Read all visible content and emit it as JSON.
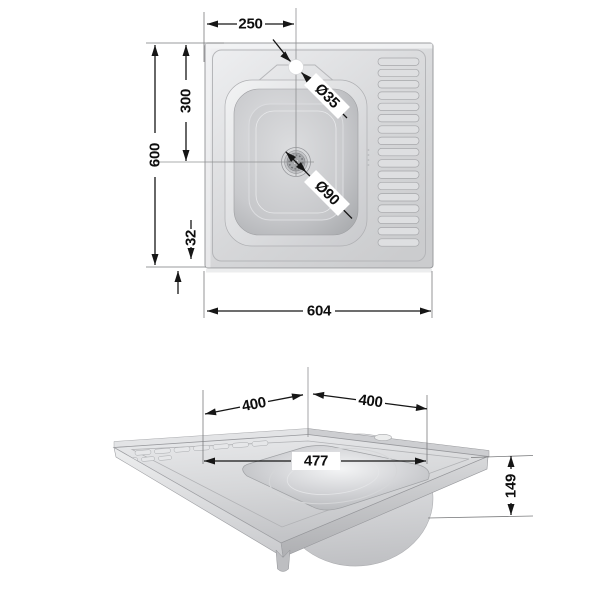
{
  "drawing": {
    "colors": {
      "dimension_line": "#161616",
      "extension_line": "#7a7b7d",
      "steel_light": "#eff0f2",
      "steel_mid": "#d3d4d7",
      "steel_dark": "#a8aaad",
      "label_chip": "#ffffff",
      "background": "#ffffff"
    },
    "top_view": {
      "dims": {
        "bowl_center_from_left": "250",
        "overall_depth": "600",
        "bowl_center_from_top": "300",
        "bottom_edge_offset": "32",
        "overall_width": "604",
        "faucet_hole_diameter": "Ø35",
        "drain_diameter": "Ø90"
      }
    },
    "perspective_view": {
      "dims": {
        "back_left_edge": "400",
        "back_right_edge": "400",
        "bowl_width": "477",
        "bowl_depth": "149"
      }
    }
  }
}
